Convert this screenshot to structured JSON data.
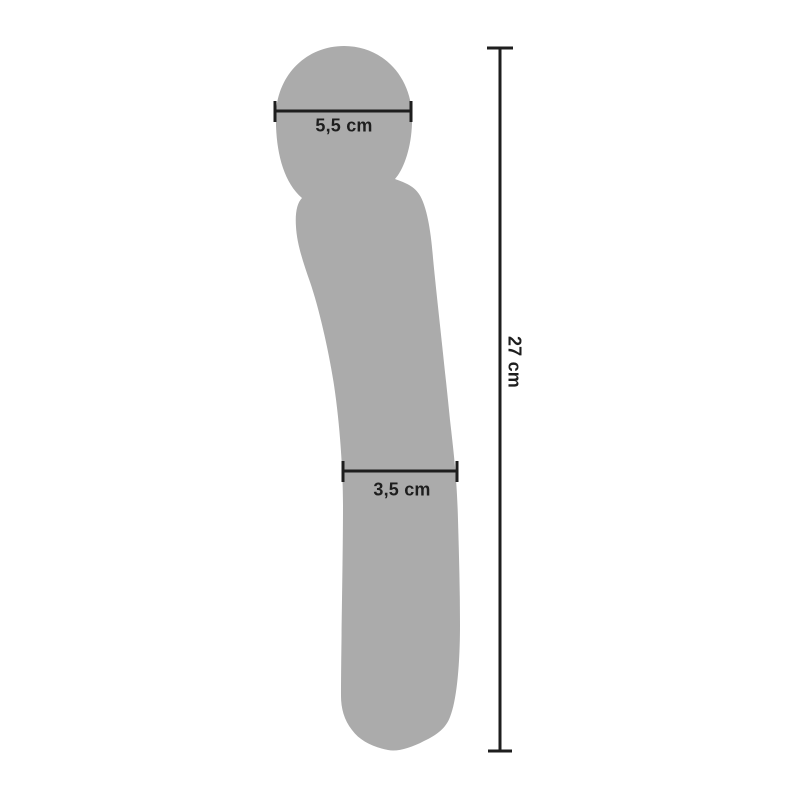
{
  "diagram": {
    "silhouette_color": "#ABABAB",
    "line_color": "#1E1E1E",
    "measurements": {
      "head_width": "5,5 cm",
      "shaft_width": "3,5 cm",
      "total_length": "27 cm"
    }
  }
}
